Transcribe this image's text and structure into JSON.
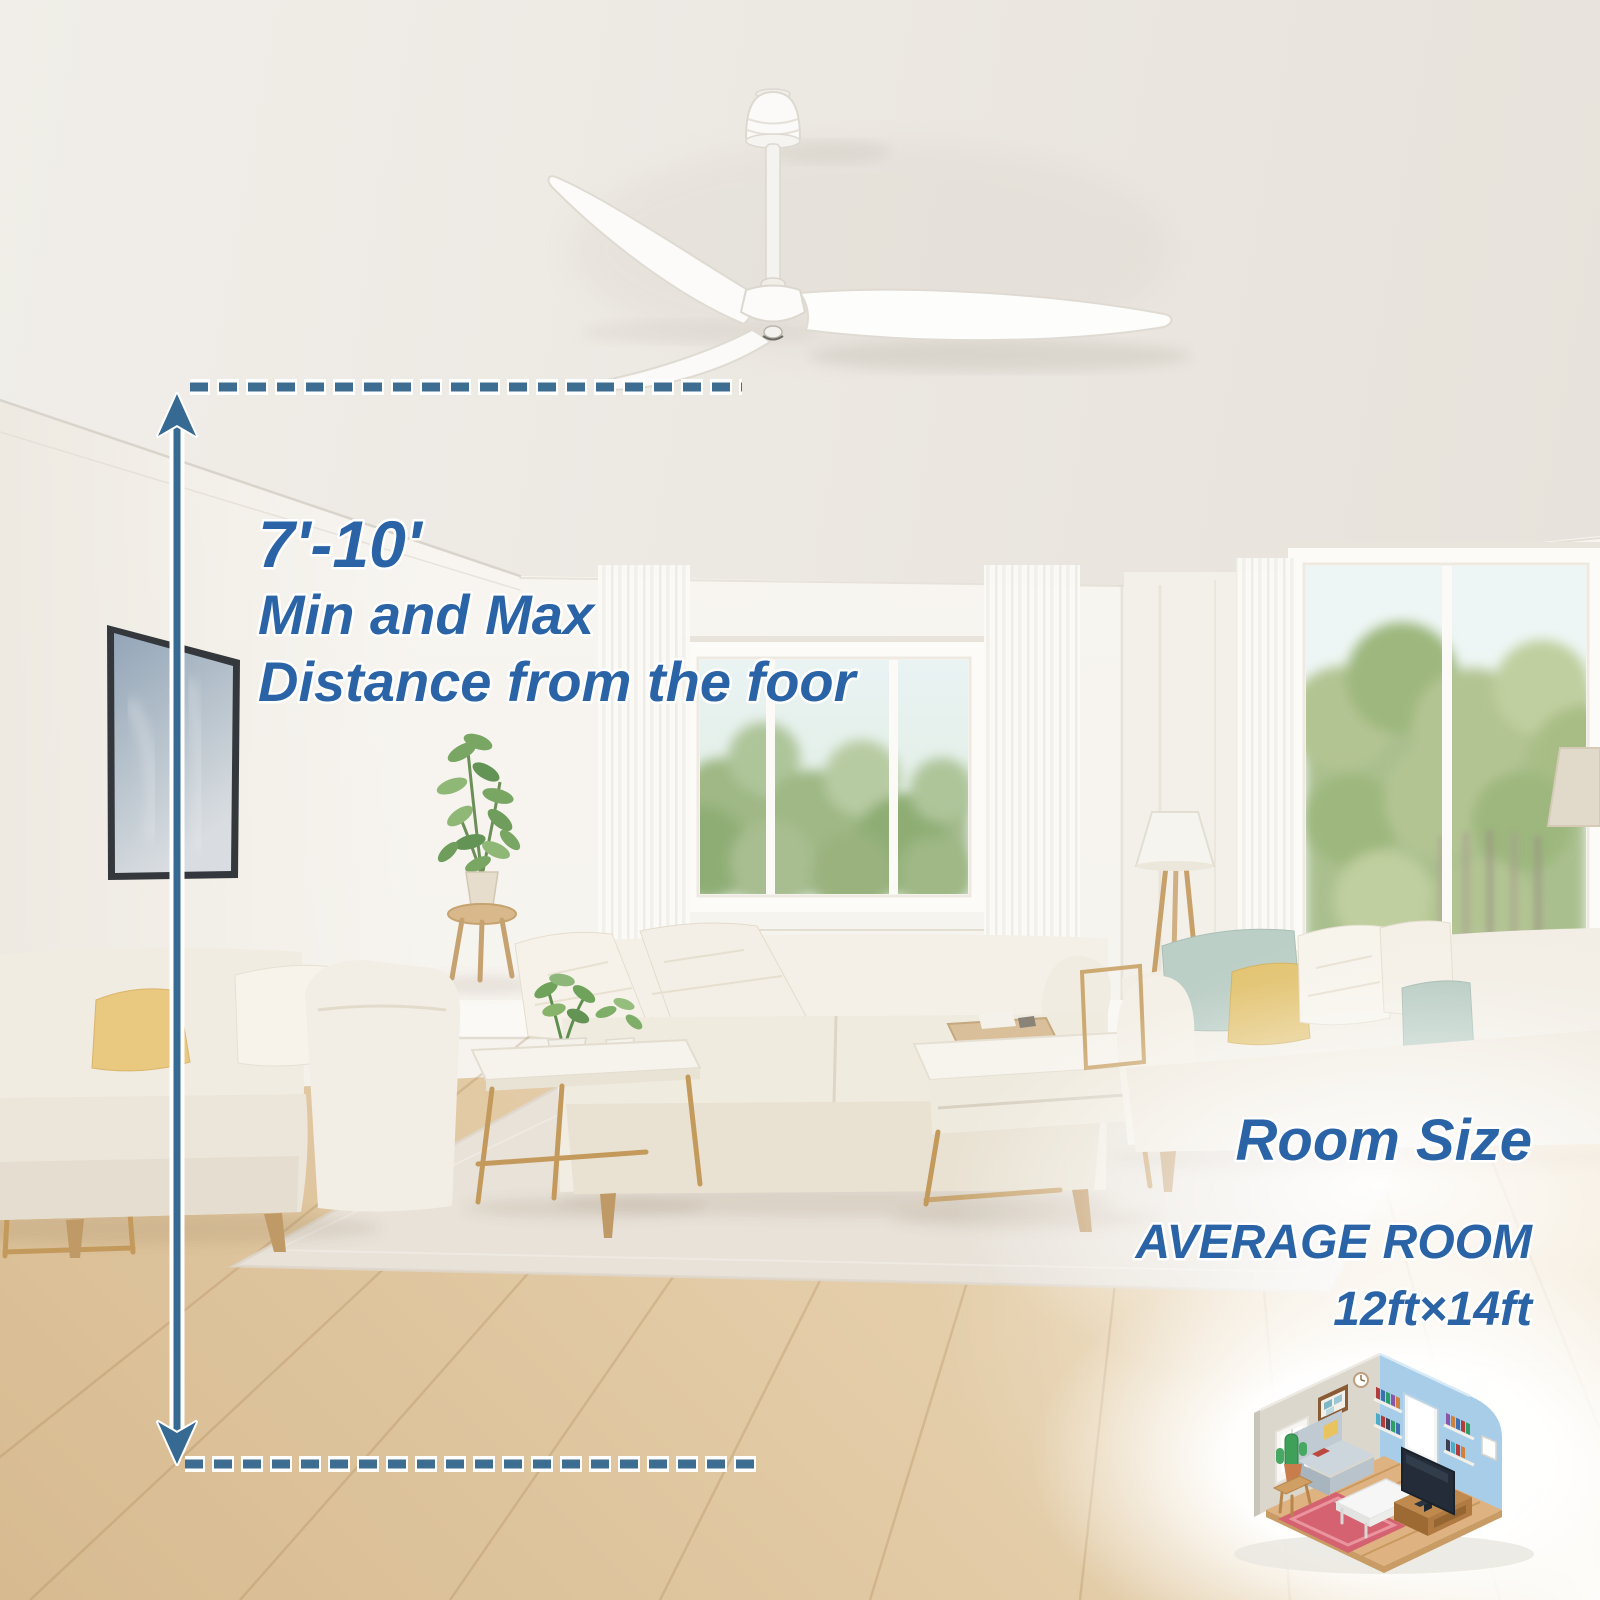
{
  "annotations": {
    "distance_note": {
      "line1": "7'-10'",
      "line2": "Min and Max",
      "line3": "Distance from the foor"
    },
    "room_size_note": {
      "heading": "Room Size",
      "subheading": "AVERAGE ROOM",
      "dimensions": "12ft×14ft"
    },
    "colors": {
      "label_text_blue": "#2b64a6",
      "measurement_blue": "#376a92",
      "outline_white": "#ffffff"
    }
  },
  "scene": {
    "subject": "white 3-blade ceiling fan in bright living room",
    "objects": [
      "ceiling-fan",
      "framed-art",
      "center-window",
      "right-window",
      "sheer-curtains",
      "tall-plant",
      "floor-lamp",
      "corner-lamp",
      "left-sofa",
      "center-sofa",
      "right-sofa",
      "side-table",
      "coffee-table",
      "tray-table",
      "area-rug",
      "wood-floor",
      "isometric-room-icon"
    ]
  }
}
